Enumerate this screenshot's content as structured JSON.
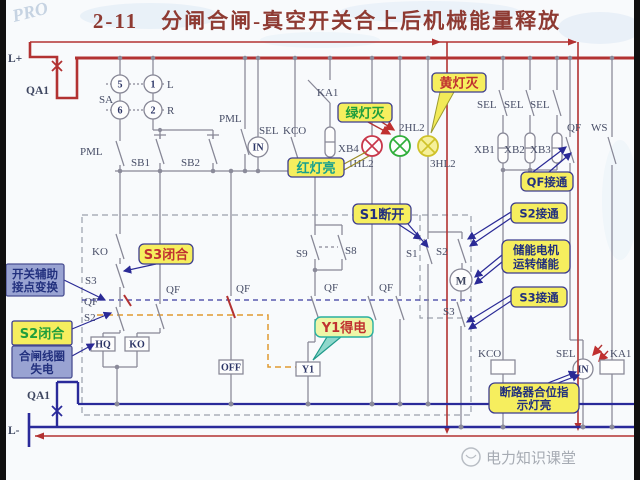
{
  "header": {
    "title": "2-11　分闸合闸-真空开关合上后机械能量释放"
  },
  "background": {
    "mark": "PRO"
  },
  "footer": {
    "watermark": "电力知识课堂"
  },
  "colors": {
    "title": "#8e3a32",
    "bus_red": "#b23232",
    "bus_blue": "#2a2a9a",
    "wire": "#878796",
    "callout_yellow": "#f6ee5e",
    "callout_blue_gray": "#99a3d2",
    "orange_path": "#e09a30",
    "lamp_red": "#c8374a",
    "lamp_green": "#2fae3a",
    "lamp_yellow": "#cfc22a"
  },
  "terminals": {
    "l_plus": "L+",
    "l_minus": "L-",
    "qa1_top": "QA1",
    "qa1_bottom": "QA1"
  },
  "selector": {
    "sa": "SA",
    "pos5": "5",
    "pos1": "1",
    "pos6": "6",
    "pos2": "2",
    "l": "L",
    "r": "R"
  },
  "labels": {
    "pml_1": "PML",
    "pml_2": "PML",
    "sb1": "SB1",
    "sb2": "SB2",
    "sel_left": "SEL",
    "kco_left": "KCO",
    "ka1_top": "KA1",
    "xb4": "XB4",
    "in_left": "IN",
    "in_right": "IN",
    "hl2_1": "1HL2",
    "hl2_2": "2HL2",
    "hl2_3": "3HL2",
    "sel_r1": "SEL",
    "sel_r2": "SEL",
    "sel_r3": "SEL",
    "xb1": "XB1",
    "xb2": "XB2",
    "xb3": "XB3",
    "qf_top": "QF",
    "ws": "WS",
    "ko_contact": "KO",
    "s3_left": "S3",
    "s2_left": "S2",
    "s9": "S9",
    "s8": "S8",
    "s1": "S1",
    "s2_mid": "S2",
    "s3_mid": "S3",
    "m": "M",
    "hq": "HQ",
    "ko_coil": "KO",
    "off": "OFF",
    "y1": "Y1",
    "kco_bottom": "KCO",
    "sel_bottom": "SEL",
    "ka1_bottom": "KA1"
  },
  "qf_labels": [
    "QF",
    "QF",
    "QF",
    "QF",
    "QF"
  ],
  "callouts": {
    "green_light_off": "绿灯灭",
    "red_light_on": "红灯亮",
    "yellow_light_off": "黄灯灭",
    "s1_open": "S1断开",
    "qf_closed": "QF接通",
    "s2_on": "S2接通",
    "motor_1": "储能电机",
    "motor_2": "运转储能",
    "s3_on": "S3接通",
    "aux_1": "开关辅助",
    "aux_2": "接点变换",
    "s2_closed": "S2闭合",
    "coil_1": "合闸线圈",
    "coil_2": "失电",
    "s3_closed": "S3闭合",
    "y1_energized": "Y1得电",
    "breaker_1": "断路器合位指",
    "breaker_2": "示灯亮"
  }
}
